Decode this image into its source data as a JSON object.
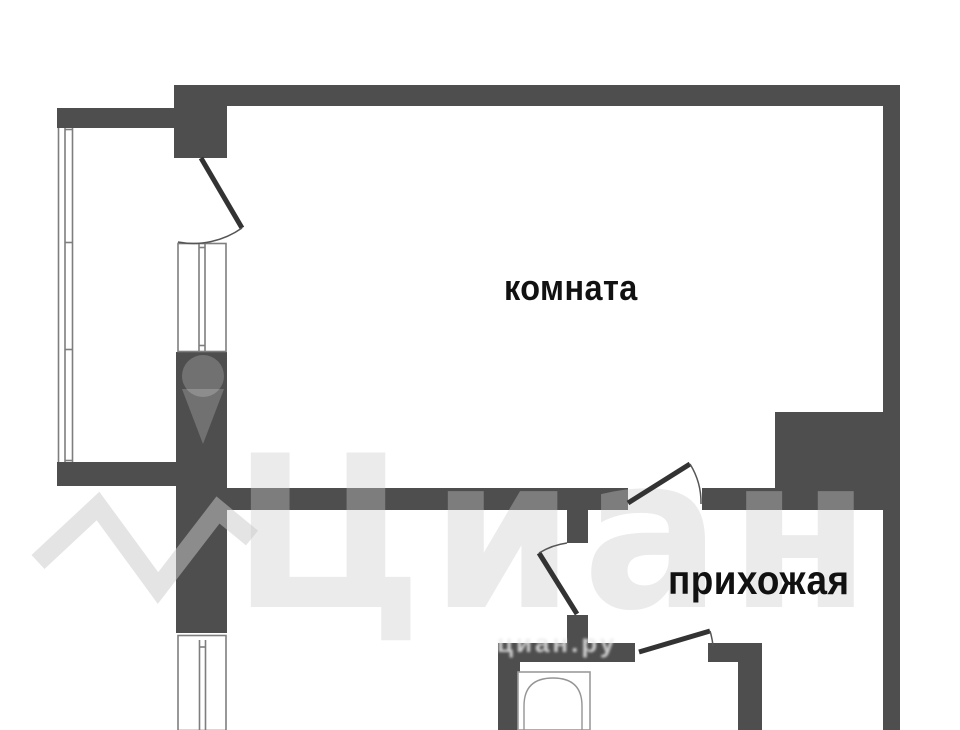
{
  "page": {
    "type": "apartment-floor-plan"
  },
  "labels": {
    "room": "комната",
    "hallway": "прихожая"
  },
  "watermark": {
    "brand": "Циан",
    "url_text": "циан.ру"
  },
  "fixtures": {
    "bathtub": "bathtub"
  },
  "colors": {
    "background": "#ffffff",
    "wall": "#4e4e4e",
    "door_line": "#333333",
    "window_line": "#7e7e7e",
    "bathtub_line": "#959595",
    "label_text": "#111111",
    "watermark": "rgba(202,202,202,0.38)"
  }
}
